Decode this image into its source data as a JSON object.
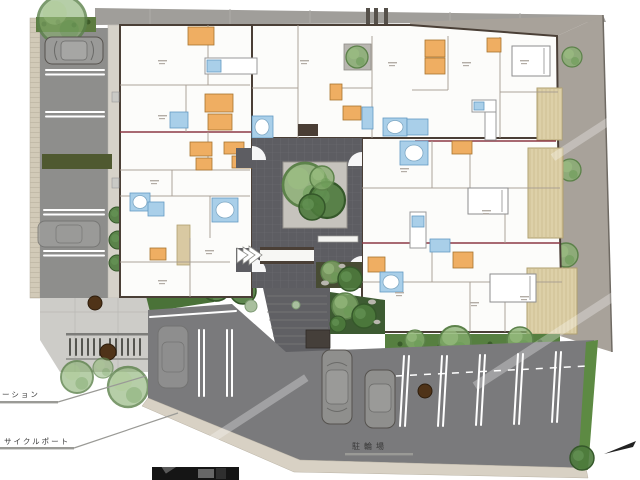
{
  "title": "apartment-site-plan-drawing",
  "labels": {
    "garbage_station_partial": "ーション",
    "cycle_port": "サイクルポート",
    "bicycle_parking": "駐輪場"
  },
  "palette": {
    "wall": "#4a3f36",
    "room_fill": "#fcfcfa",
    "closet_orange": "#efae62",
    "bath_blue": "#a9cfe9",
    "courtyard_paving": "#5d5d62",
    "left_parking_asphalt": "#8e8e8c",
    "bottom_lot_asphalt": "#7a7a7c",
    "boundary_gravel": "#a8a29a",
    "hedge_green": "#567f40",
    "tree_green": "#86ad6d",
    "deck_tan": "#ddd0a8",
    "unit_divider_red": "#8c3844",
    "concrete": "#cdccc8",
    "stall_marking": "#ffffff"
  }
}
